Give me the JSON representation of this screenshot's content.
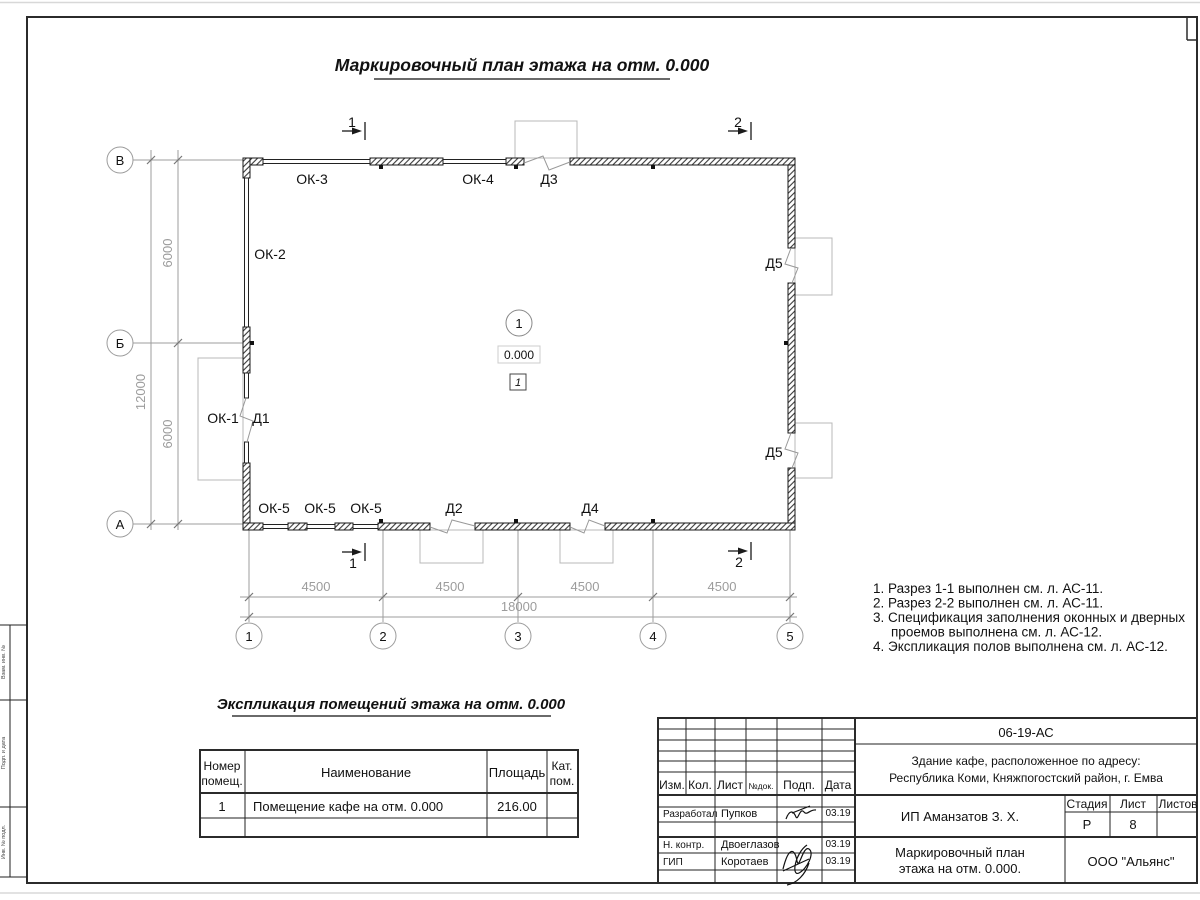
{
  "titles": {
    "main": "Маркировочный план этажа на отм. 0.000",
    "table": "Экспликация помещений этажа на отм. 0.000"
  },
  "plan": {
    "row_axes": [
      "В",
      "Б",
      "А"
    ],
    "col_axes": [
      "1",
      "2",
      "3",
      "4",
      "5"
    ],
    "dim_span": "4500",
    "dim_total": "18000",
    "dim_v_span": "6000",
    "dim_v_total": "12000",
    "windows": {
      "ok1": "ОК-1",
      "ok2": "ОК-2",
      "ok3": "ОК-3",
      "ok4": "ОК-4",
      "ok5": "ОК-5"
    },
    "doors": {
      "d1": "Д1",
      "d2": "Д2",
      "d3": "Д3",
      "d4": "Д4",
      "d5": "Д5"
    },
    "section1": "1",
    "section2": "2",
    "room_number": "1",
    "elevation": "0.000",
    "floor_mark": "1"
  },
  "notes": {
    "lines": [
      "1. Разрез 1-1 выполнен см. л. АС-11.",
      "2. Разрез 2-2 выполнен см. л. АС-11.",
      "3. Спецификация заполнения оконных и дверных",
      "проемов выполнена см. л. АС-12.",
      "4. Экспликация полов выполнена см. л. АС-12."
    ]
  },
  "room_table": {
    "header_num_1": "Номер",
    "header_num_2": "помещ.",
    "header_name": "Наименование",
    "header_area": "Площадь",
    "header_cat_1": "Кат.",
    "header_cat_2": "пом.",
    "row": {
      "num": "1",
      "name": "Помещение кафе на отм. 0.000",
      "area": "216.00",
      "cat": ""
    }
  },
  "title_block": {
    "doc_number": "06-19-АС",
    "address_line1": "Здание кафе, расположенное по адресу:",
    "address_line2": "Республика Коми, Княжпогостский район, г. Емва",
    "cols": {
      "izm": "Изм.",
      "kol": "Кол.",
      "list": "Лист",
      "doc": "№док.",
      "podp": "Подп.",
      "data": "Дата"
    },
    "rows": [
      {
        "role": "Разработал",
        "name": "Пупков",
        "date": "03.19"
      },
      {
        "role": "Н. контр.",
        "name": "Двоеглазов",
        "date": "03.19"
      },
      {
        "role": "ГИП",
        "name": "Коротаев",
        "date": "03.19"
      }
    ],
    "client": "ИП Аманзатов З. Х.",
    "stage_label": "Стадия",
    "sheet_label": "Лист",
    "sheets_label": "Листов",
    "stage": "Р",
    "sheet": "8",
    "sheets": "",
    "drawing_title_1": "Маркировочный план",
    "drawing_title_2": "этажа на отм. 0.000.",
    "company": "ООО \"Альянс\""
  },
  "margin": {
    "labels": [
      "Взам. инв. №",
      "Подп. и дата",
      "Инв. № подл."
    ]
  },
  "colors": {
    "line": "#1a1a1a",
    "dim": "#9c9c9c"
  }
}
